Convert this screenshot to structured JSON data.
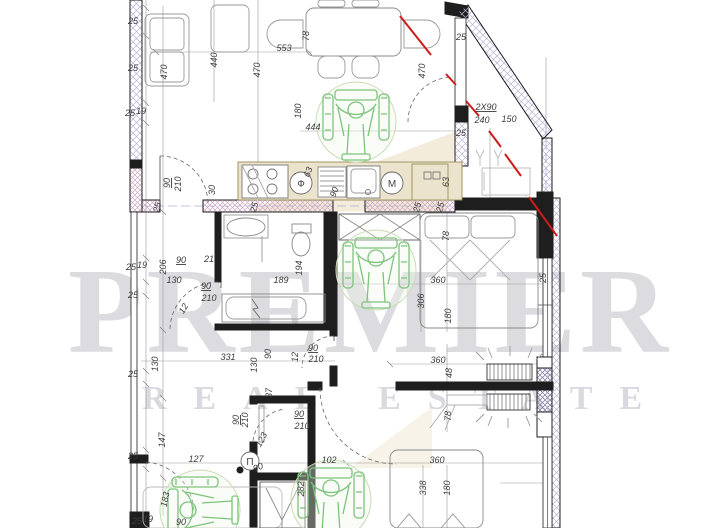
{
  "watermark": {
    "line1": "PREMIER",
    "line2": "REAL ESTATE"
  },
  "colors": {
    "wall_black": "#1e1e1e",
    "hatch_blue": "#b9b3d4",
    "hatch_pink": "#cfa8c4",
    "kitchen_beige": "#ebe3cb",
    "logo_tan": "#e9ddbd",
    "accessible_green": "#7cc47c",
    "marker_red": "#cf1b1b",
    "centerline_blue": "#9b9bd6",
    "dim_text": "#3c3c3c"
  },
  "symbols": {
    "stove_hood": "Ф",
    "washing_machine": "M",
    "boiler": "П"
  },
  "plan": {
    "labels": [
      {
        "t": "25",
        "x": 133,
        "y": 24
      },
      {
        "t": "25",
        "x": 133,
        "y": 71
      },
      {
        "t": "25",
        "x": 130,
        "y": 116
      },
      {
        "t": "19",
        "x": 141,
        "y": 114
      },
      {
        "t": "470",
        "x": 167,
        "y": 72,
        "r": -90
      },
      {
        "t": "440",
        "x": 217,
        "y": 60,
        "r": -90
      },
      {
        "t": "470",
        "x": 260,
        "y": 70,
        "r": -90
      },
      {
        "t": "553",
        "x": 284,
        "y": 51
      },
      {
        "t": "78",
        "x": 309,
        "y": 36,
        "r": -90
      },
      {
        "t": "470",
        "x": 425,
        "y": 71,
        "r": -90
      },
      {
        "t": "25",
        "x": 461,
        "y": 40
      },
      {
        "t": "180",
        "x": 301,
        "y": 111,
        "r": -90
      },
      {
        "t": "444",
        "x": 313,
        "y": 130
      },
      {
        "t": "2X90",
        "x": 486,
        "y": 110,
        "u": 1
      },
      {
        "t": "240",
        "x": 482,
        "y": 123
      },
      {
        "t": "150",
        "x": 509,
        "y": 122
      },
      {
        "t": "25",
        "x": 461,
        "y": 136
      },
      {
        "t": "90",
        "x": 170,
        "y": 183,
        "r": -90,
        "u": 1
      },
      {
        "t": "210",
        "x": 181,
        "y": 184,
        "r": -90
      },
      {
        "t": "30",
        "x": 215,
        "y": 190,
        "r": -90
      },
      {
        "t": "63",
        "x": 311,
        "y": 173,
        "r": -70
      },
      {
        "t": "63",
        "x": 449,
        "y": 182,
        "r": -90
      },
      {
        "t": "25",
        "x": 160,
        "y": 208,
        "r": -75
      },
      {
        "t": "25",
        "x": 257,
        "y": 208,
        "r": -75
      },
      {
        "t": "90",
        "x": 337,
        "y": 193,
        "r": -70
      },
      {
        "t": "25",
        "x": 420,
        "y": 208,
        "r": -75
      },
      {
        "t": "25",
        "x": 443,
        "y": 208,
        "r": -75
      },
      {
        "t": "25",
        "x": 131,
        "y": 270
      },
      {
        "t": "19",
        "x": 142,
        "y": 268
      },
      {
        "t": "206",
        "x": 166,
        "y": 267,
        "r": -90
      },
      {
        "t": "25",
        "x": 133,
        "y": 298
      },
      {
        "t": "90",
        "x": 181,
        "y": 263,
        "u": 1
      },
      {
        "t": "21",
        "x": 209,
        "y": 262
      },
      {
        "t": "130",
        "x": 174,
        "y": 283
      },
      {
        "t": "90",
        "x": 206,
        "y": 289,
        "u": 1
      },
      {
        "t": "210",
        "x": 209,
        "y": 301
      },
      {
        "t": "12",
        "x": 186,
        "y": 310,
        "r": -60
      },
      {
        "t": "189",
        "x": 281,
        "y": 283
      },
      {
        "t": "194",
        "x": 302,
        "y": 268,
        "r": -90
      },
      {
        "t": "78",
        "x": 449,
        "y": 236,
        "r": -90
      },
      {
        "t": "360",
        "x": 438,
        "y": 283
      },
      {
        "t": "306",
        "x": 424,
        "y": 301,
        "r": -90
      },
      {
        "t": "180",
        "x": 451,
        "y": 316,
        "r": -90
      },
      {
        "t": "25",
        "x": 546,
        "y": 278,
        "r": -90
      },
      {
        "t": "90",
        "x": 313,
        "y": 351,
        "u": 1
      },
      {
        "t": "210",
        "x": 316,
        "y": 362
      },
      {
        "t": "12",
        "x": 298,
        "y": 357,
        "r": -90
      },
      {
        "t": "130",
        "x": 158,
        "y": 364,
        "r": -90
      },
      {
        "t": "331",
        "x": 228,
        "y": 360
      },
      {
        "t": "130",
        "x": 257,
        "y": 365,
        "r": -90
      },
      {
        "t": "90",
        "x": 271,
        "y": 354,
        "r": -90
      },
      {
        "t": "37",
        "x": 272,
        "y": 393,
        "r": -90
      },
      {
        "t": "360",
        "x": 438,
        "y": 363
      },
      {
        "t": "48",
        "x": 452,
        "y": 373,
        "r": -90
      },
      {
        "t": "78",
        "x": 451,
        "y": 416,
        "r": -90
      },
      {
        "t": "25",
        "x": 133,
        "y": 377
      },
      {
        "t": "147",
        "x": 165,
        "y": 440,
        "r": -90
      },
      {
        "t": "25",
        "x": 133,
        "y": 459
      },
      {
        "t": "127",
        "x": 196,
        "y": 462
      },
      {
        "t": "183",
        "x": 168,
        "y": 500,
        "r": -78
      },
      {
        "t": "90",
        "x": 239,
        "y": 420,
        "r": -90,
        "u": 1
      },
      {
        "t": "210",
        "x": 248,
        "y": 420,
        "r": -90
      },
      {
        "t": "123",
        "x": 264,
        "y": 441,
        "r": -62
      },
      {
        "t": "90",
        "x": 299,
        "y": 417,
        "u": 1
      },
      {
        "t": "210",
        "x": 302,
        "y": 429
      },
      {
        "t": "90",
        "x": 259,
        "y": 470,
        "r": -20
      },
      {
        "t": "102",
        "x": 329,
        "y": 463
      },
      {
        "t": "282",
        "x": 304,
        "y": 489,
        "r": -90
      },
      {
        "t": "360",
        "x": 437,
        "y": 463
      },
      {
        "t": "338",
        "x": 426,
        "y": 488,
        "r": -90
      },
      {
        "t": "180",
        "x": 450,
        "y": 488,
        "r": -90
      },
      {
        "t": "25",
        "x": 137,
        "y": 524
      },
      {
        "t": "19",
        "x": 148,
        "y": 522
      },
      {
        "t": "90",
        "x": 181,
        "y": 525
      },
      {
        "t": "Ф",
        "x": 301,
        "y": 187,
        "cls": "sym"
      },
      {
        "t": "M",
        "x": 392,
        "y": 187,
        "cls": "sym"
      },
      {
        "t": "П",
        "x": 250,
        "y": 465,
        "cls": "sym"
      }
    ]
  }
}
